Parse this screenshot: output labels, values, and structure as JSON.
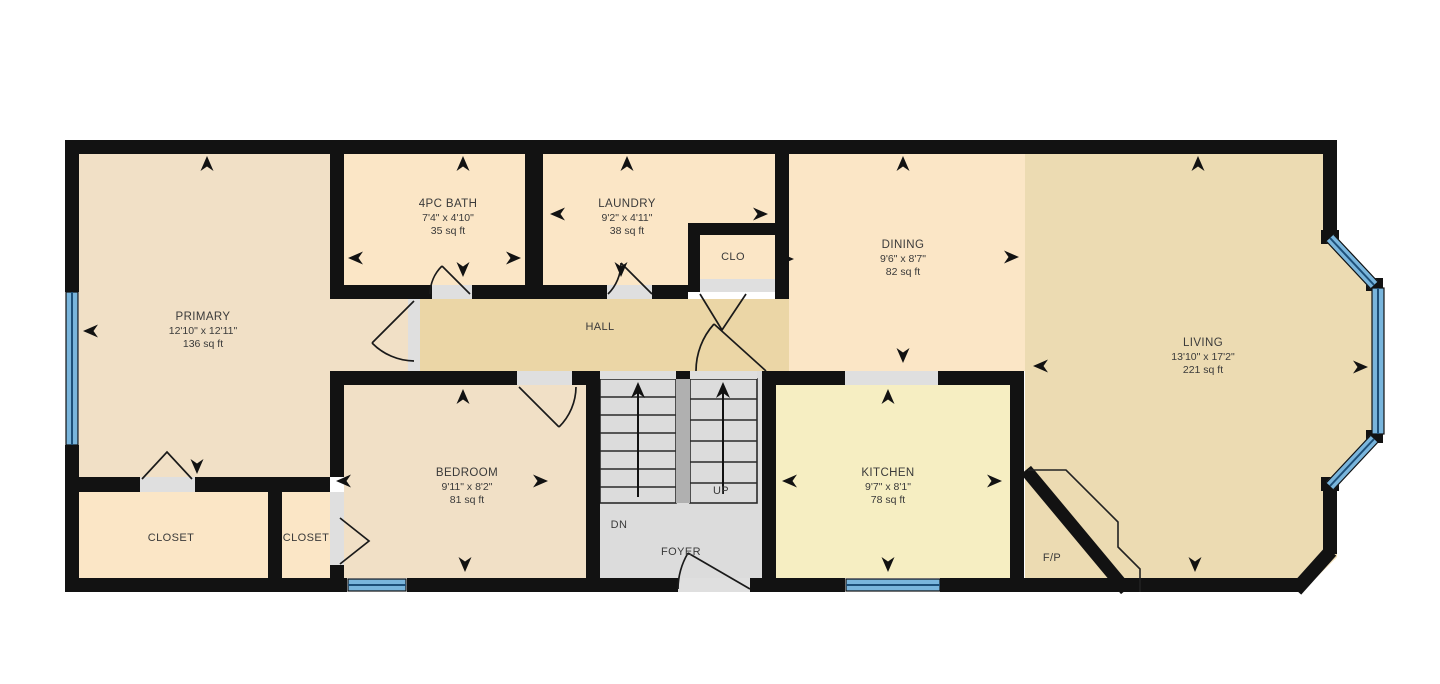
{
  "floorplan": {
    "colors": {
      "background": "#ffffff",
      "wall": "#121212",
      "window": "#79b5dc",
      "window_line": "#1d4f78",
      "threshold": "#dfdfdf",
      "stairs": "#dcdcdc",
      "stair_divider": "#b0b0b0",
      "door": "#1a1a1a"
    },
    "rooms": [
      {
        "id": "primary",
        "name": "PRIMARY",
        "dimensions": "12'10\" x 12'11\"",
        "area": "136 sq ft",
        "color": "#f1e0c6"
      },
      {
        "id": "bath",
        "name": "4PC BATH",
        "dimensions": "7'4\" x 4'10\"",
        "area": "35 sq ft",
        "color": "#fbe6c6"
      },
      {
        "id": "laundry",
        "name": "LAUNDRY",
        "dimensions": "9'2\" x 4'11\"",
        "area": "38 sq ft",
        "color": "#fbe6c6"
      },
      {
        "id": "dining",
        "name": "DINING",
        "dimensions": "9'6\" x 8'7\"",
        "area": "82 sq ft",
        "color": "#fbe6c6"
      },
      {
        "id": "living",
        "name": "LIVING",
        "dimensions": "13'10\" x 17'2\"",
        "area": "221 sq ft",
        "color": "#ecdbb2"
      },
      {
        "id": "bedroom",
        "name": "BEDROOM",
        "dimensions": "9'11\" x 8'2\"",
        "area": "81 sq ft",
        "color": "#f1e0c6"
      },
      {
        "id": "kitchen",
        "name": "KITCHEN",
        "dimensions": "9'7\" x 8'1\"",
        "area": "78 sq ft",
        "color": "#f6eec2"
      }
    ],
    "spaces": {
      "hall": {
        "label": "HALL",
        "color": "#ebd6a6"
      },
      "clo": {
        "label": "CLO",
        "color": "#fbe6c6"
      },
      "closet1": {
        "label": "CLOSET",
        "color": "#fbe6c6"
      },
      "closet2": {
        "label": "CLOSET",
        "color": "#fbe6c6"
      },
      "foyer": {
        "label": "FOYER"
      },
      "stairs_up": {
        "label": "UP"
      },
      "stairs_dn": {
        "label": "DN"
      },
      "fireplace": {
        "label": "F/P"
      }
    }
  }
}
